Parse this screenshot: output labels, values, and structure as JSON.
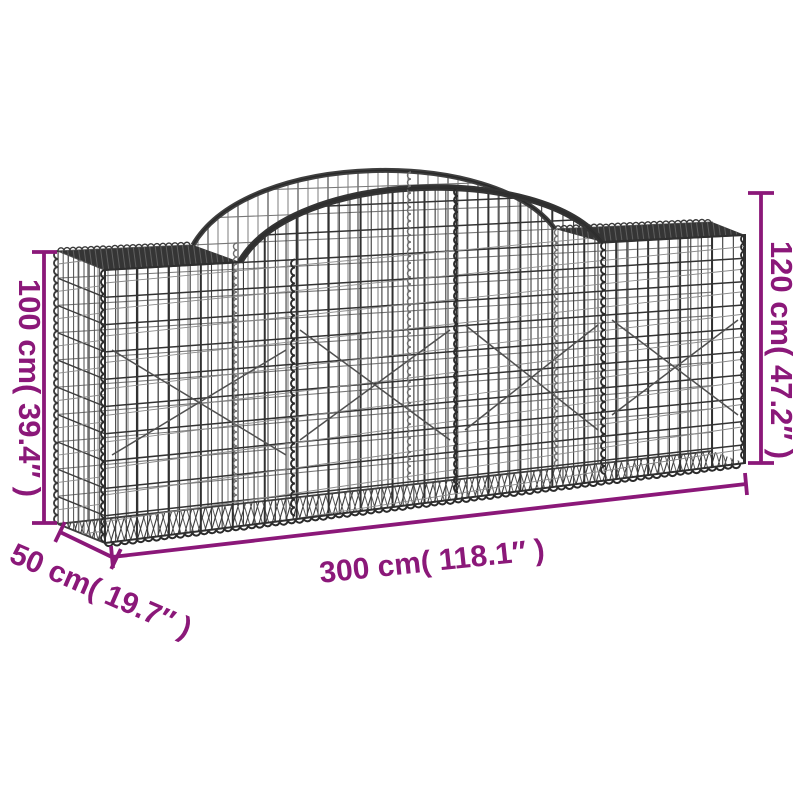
{
  "illustration": {
    "name": "arched-gabion-basket-wire-mesh",
    "style": "galvanised iron wire line drawing"
  },
  "dimensions": {
    "height_left": {
      "label": "100 cm( 39.4″ )",
      "cm": 100,
      "inch": 39.4
    },
    "height_right": {
      "label": "120 cm( 47.2″ )",
      "cm": 120,
      "inch": 47.2
    },
    "length": {
      "label": "300 cm( 118.1″ )",
      "cm": 300,
      "inch": 118.1
    },
    "depth": {
      "label": "50 cm( 19.7″ )",
      "cm": 50,
      "inch": 19.7
    }
  },
  "colors": {
    "accent": "#8B1879",
    "wire": "#333333",
    "wire_light": "#787878",
    "background": "#FFFFFF"
  }
}
